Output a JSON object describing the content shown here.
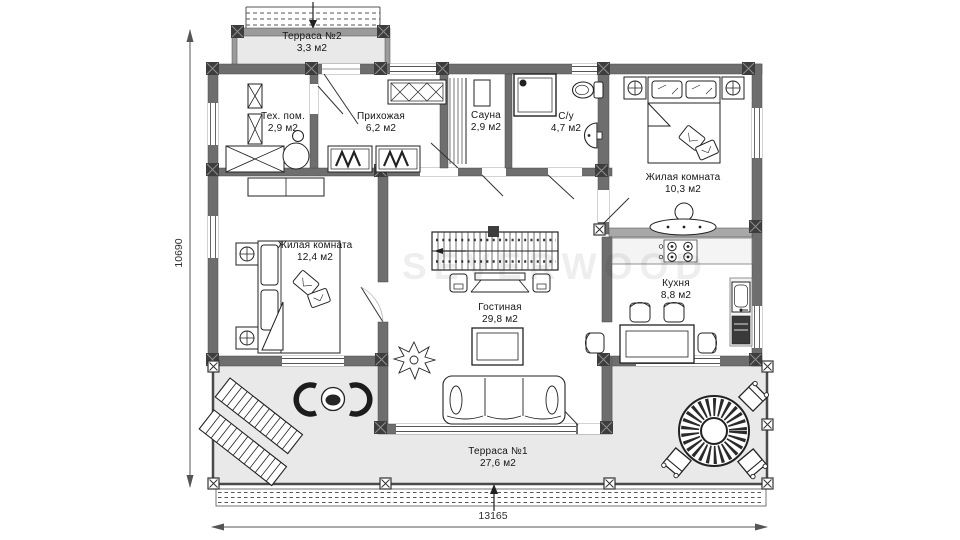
{
  "plan": {
    "watermark": "SEVERWOOD",
    "rooms": [
      {
        "id": "terrace2",
        "name": "Терраса №2",
        "area": "3,3 м2"
      },
      {
        "id": "tech",
        "name": "Тех. пом.",
        "area": "2,9 м2"
      },
      {
        "id": "hall",
        "name": "Прихожая",
        "area": "6,2 м2"
      },
      {
        "id": "sauna",
        "name": "Сауна",
        "area": "2,9 м2"
      },
      {
        "id": "wc",
        "name": "С/у",
        "area": "4,7 м2"
      },
      {
        "id": "bedroom2",
        "name": "Жилая комната",
        "area": "10,3 м2"
      },
      {
        "id": "bedroom1",
        "name": "Жилая комната",
        "area": "12,4 м2"
      },
      {
        "id": "living",
        "name": "Гостиная",
        "area": "29,8 м2"
      },
      {
        "id": "kitchen",
        "name": "Кухня",
        "area": "8,8 м2"
      },
      {
        "id": "terrace1",
        "name": "Терраса №1",
        "area": "27,6 м2"
      }
    ],
    "dimensions": {
      "height_mm": "10690",
      "width_mm": "13165"
    },
    "colors": {
      "wall": "#6e6e6e",
      "post": "#3d3d3d",
      "terrace_fill": "#e9e9e9",
      "line": "#222222"
    }
  }
}
